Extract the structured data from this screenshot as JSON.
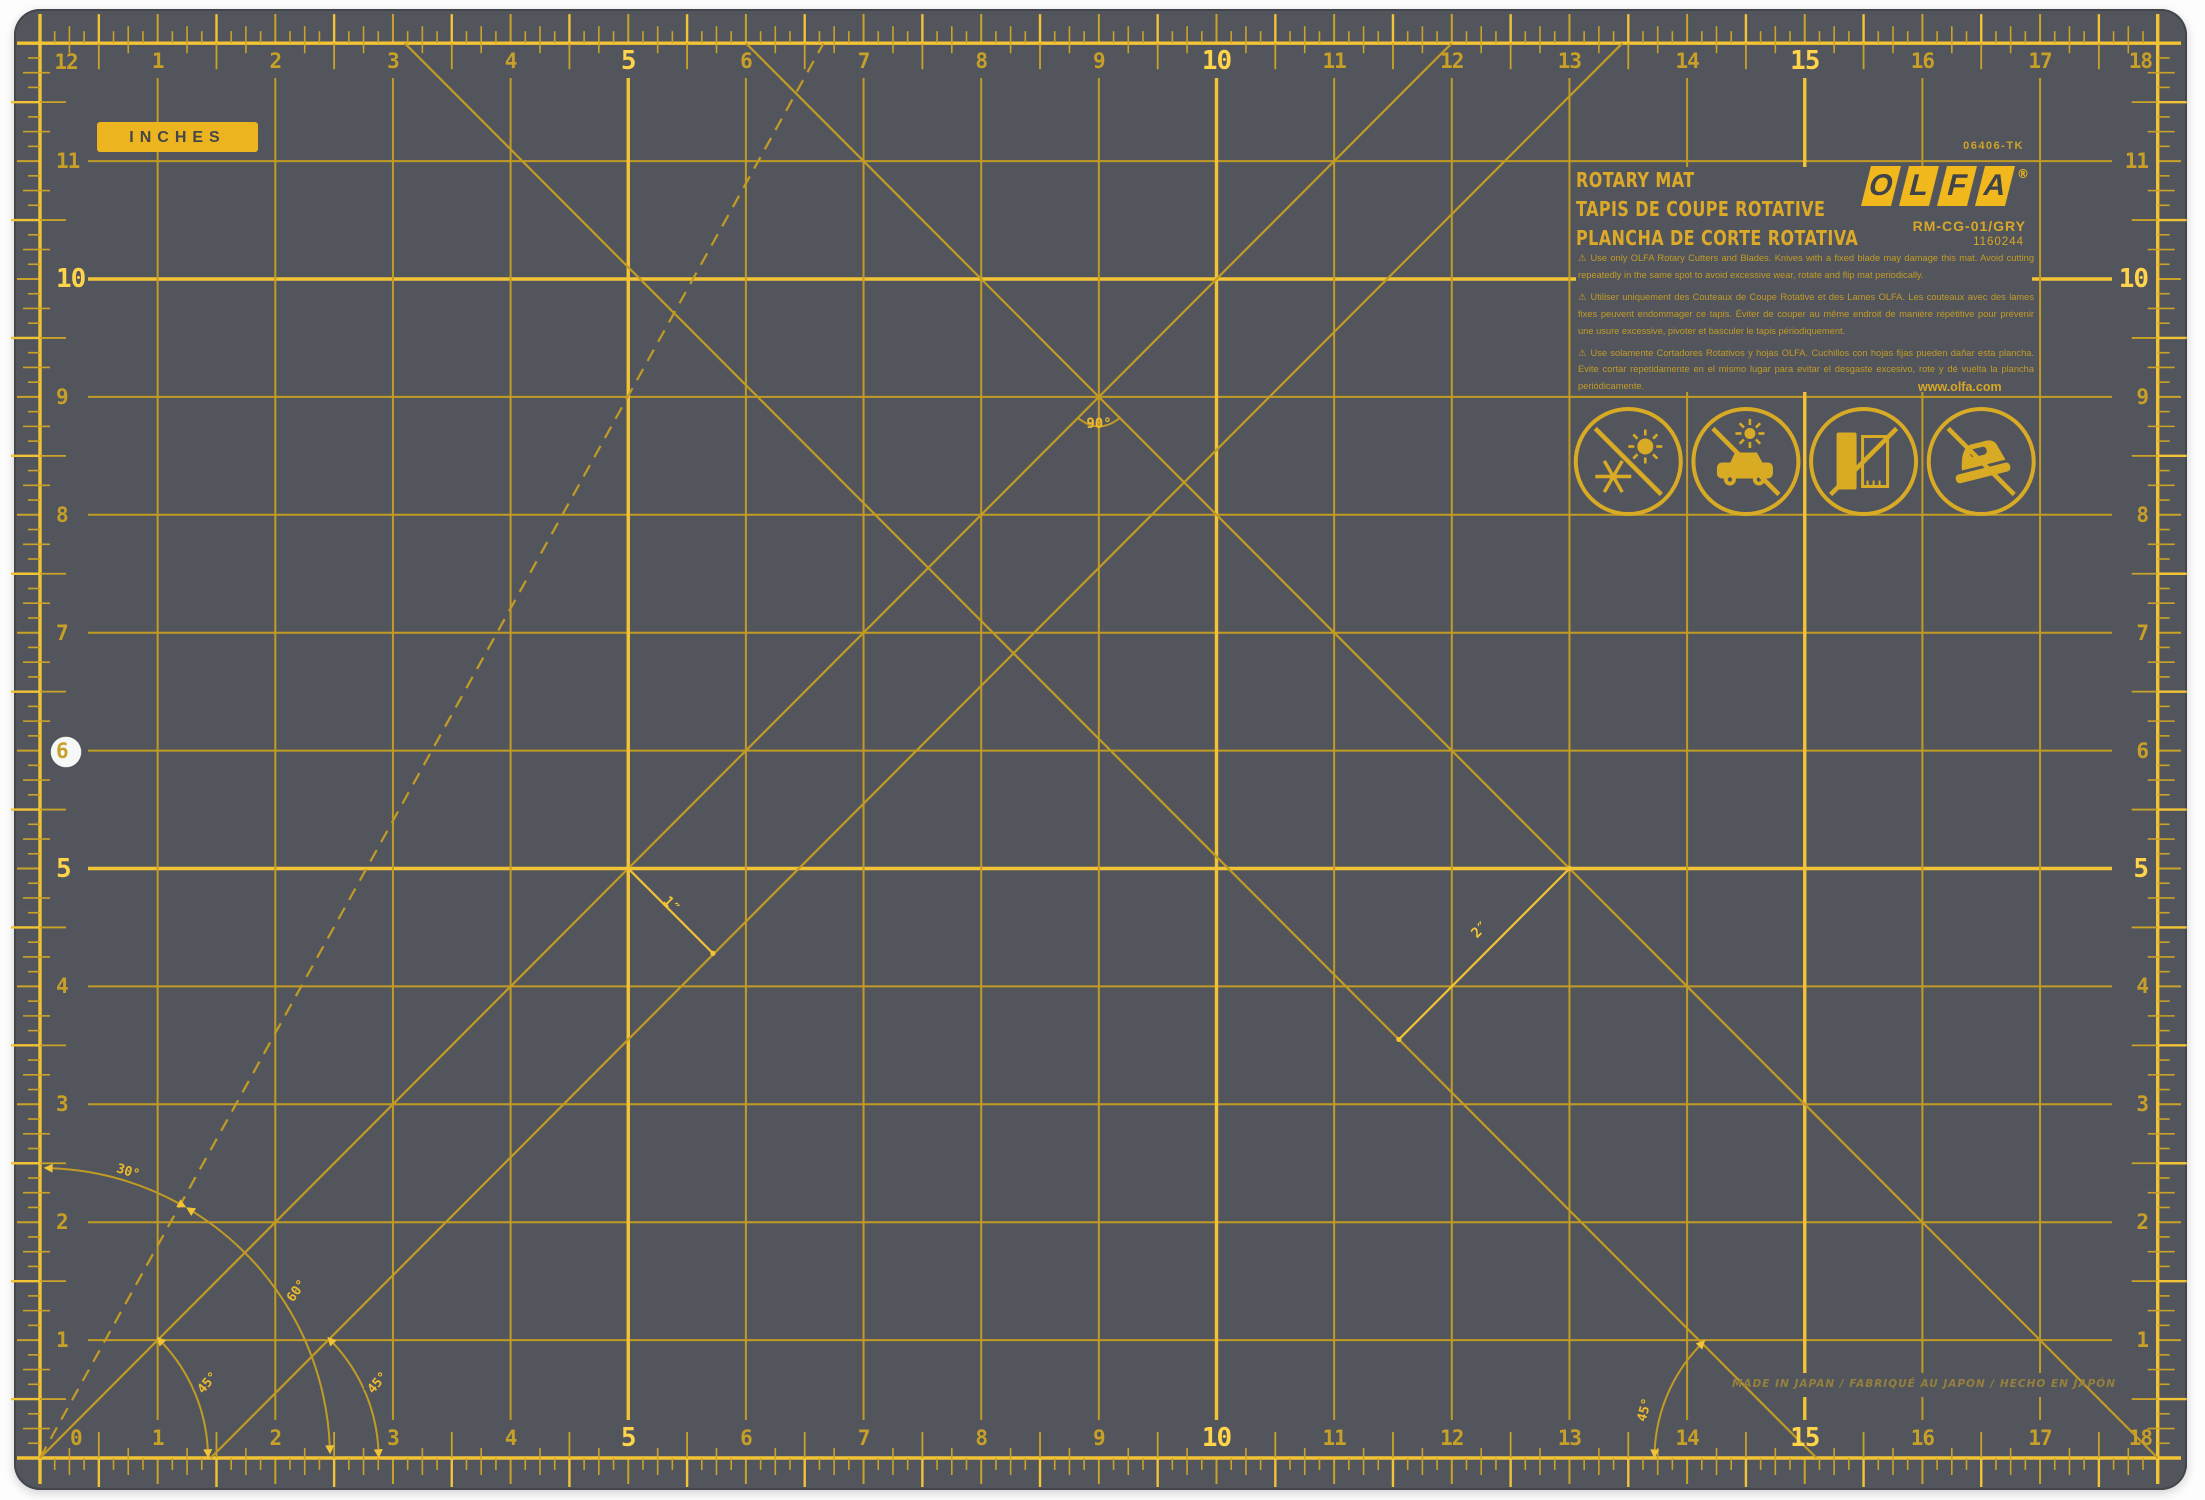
{
  "badge": "INCHES",
  "brand": {
    "sku": "06406-TK",
    "logo": [
      "O",
      "L",
      "F",
      "A"
    ],
    "reg": "®",
    "titles": [
      "ROTARY MAT",
      "TAPIS DE COUPE ROTATIVE",
      "PLANCHA DE CORTE ROTATIVA"
    ],
    "model": "RM-CG-01/GRY",
    "item": "1160244",
    "site": "www.olfa.com"
  },
  "warnings": [
    "⚠ Use only OLFA Rotary Cutters and Blades. Knives with a fixed blade may damage this mat. Avoid cutting repeatedly in the same spot to avoid excessive wear, rotate and flip mat periodically.",
    "⚠ Utiliser uniquement des Couteaux de Coupe Rotative et des Lames OLFA. Les couteaux avec des lames fixes peuvent endommager ce tapis. Éviter de couper au même endroit de manière répétitive pour prévenir une usure excessive, pivoter et basculer le tapis périodiquement.",
    "⚠ Use solamente Cortadores Rotativos y hojas OLFA. Cuchillos con hojas fijas pueden dañar esta plancha. Evite cortar repetidamente en el mismo lugar para evitar el desgaste excesivo, rote y dé vuelta la plancha periódicamente."
  ],
  "made_in": "MADE IN JAPAN / FABRIQUÉ AU JAPON / HECHO EN JAPÓN",
  "labels": {
    "a90": "90°",
    "a30": "30°",
    "a60": "60°",
    "a45": "45°",
    "d1": "1″",
    "d2": "2″"
  },
  "rulers": {
    "top": [
      "1",
      "2",
      "3",
      "4",
      "5",
      "6",
      "7",
      "8",
      "9",
      "10",
      "11",
      "12",
      "13",
      "14",
      "15",
      "16",
      "17",
      "18"
    ],
    "bottom": [
      "0",
      "1",
      "2",
      "3",
      "4",
      "5",
      "6",
      "7",
      "8",
      "9",
      "10",
      "11",
      "12",
      "13",
      "14",
      "15",
      "16",
      "17",
      "18"
    ],
    "left": [
      "12",
      "11",
      "10",
      "9",
      "8",
      "7",
      "6",
      "5",
      "4",
      "3",
      "2",
      "1"
    ],
    "right": [
      "11",
      "10",
      "9",
      "8",
      "7",
      "6",
      "5",
      "4",
      "3",
      "2",
      "1"
    ],
    "bold": [
      "5",
      "10",
      "15"
    ]
  },
  "icons": [
    {
      "name": "no-temperature-extremes-icon"
    },
    {
      "name": "no-hot-car-icon"
    },
    {
      "name": "no-folding-icon"
    },
    {
      "name": "no-ironing-icon"
    }
  ],
  "colors": {
    "mat": "#52565c",
    "grid": "#c29b25",
    "grid_bold": "#f2c335",
    "tick": "#caa227",
    "number": "#c8a027",
    "number_bold": "#ffd34a",
    "brand_yellow": "#f0b81c",
    "icon": "#d9ab25",
    "hole": "#f6f7f7"
  }
}
